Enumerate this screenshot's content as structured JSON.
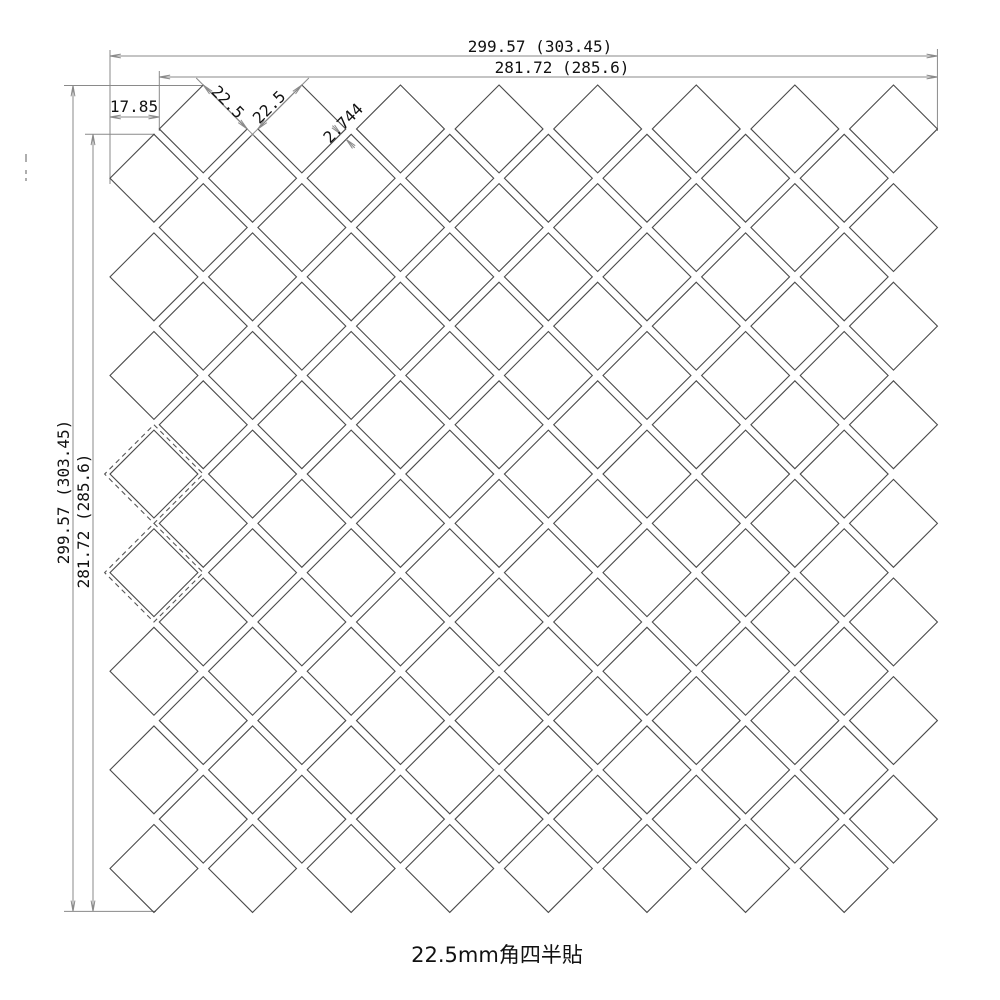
{
  "drawing": {
    "title": "22.5mm角四半貼",
    "dimensions": {
      "top_outer": "299.57 (303.45)",
      "top_inner": "281.72 (285.6)",
      "left_outer": "299.57 (303.45)",
      "left_inner": "281.72 (285.6)",
      "corner_offset": "17.85",
      "tile_edge_a": "22.5",
      "tile_edge_b": "22.5",
      "joint": "2.744"
    },
    "pattern": {
      "type": "diagonal-square-mosaic",
      "tile_size_mm": 22.5,
      "joint_mm": 2.744,
      "grid_cells": 16,
      "occupied_parity": "odd",
      "full_tile_count": 128,
      "dashed_module_cells": [
        [
          0,
          7
        ],
        [
          0,
          9
        ]
      ]
    },
    "colors": {
      "tile_line": "#4a4a4a",
      "dim_line": "#8a8a8a",
      "text": "#111111"
    }
  }
}
